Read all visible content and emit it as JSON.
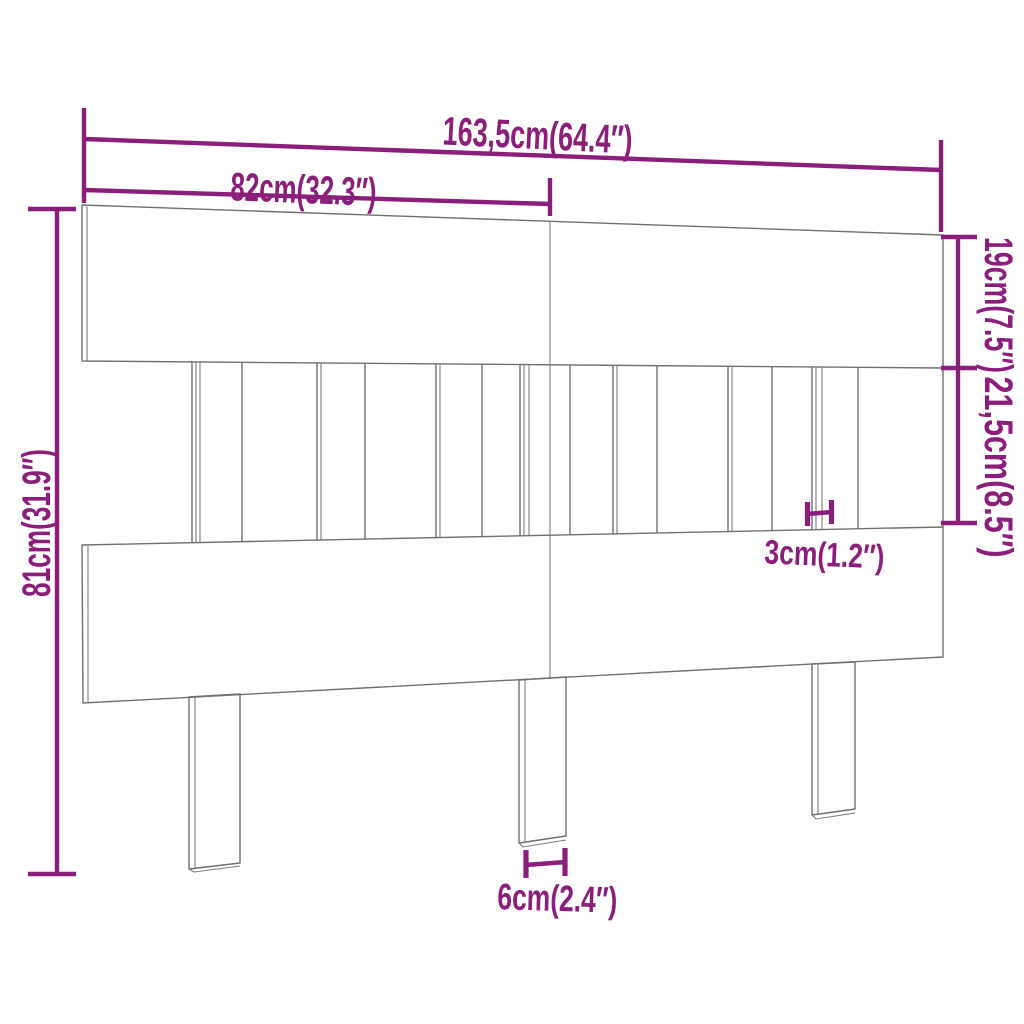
{
  "diagram": {
    "name": "headboard-dimension-diagram",
    "background": "#ffffff",
    "accent_color": "#8B1E7B",
    "outline_color": "#707070",
    "parts": [
      "top-board",
      "slat-section",
      "bottom-board",
      "left-leg",
      "center-leg",
      "right-leg"
    ],
    "dimensions": [
      {
        "id": "overall-width",
        "label": "163,5cm(64.4″)",
        "cm": "163,5",
        "inches": "64.4"
      },
      {
        "id": "half-width",
        "label": "82cm(32.3″)",
        "cm": "82",
        "inches": "32.3"
      },
      {
        "id": "overall-height",
        "label": "81cm(31.9″)",
        "cm": "81",
        "inches": "31.9"
      },
      {
        "id": "top-board-height",
        "label": "19cm(7.5″)",
        "cm": "19",
        "inches": "7.5"
      },
      {
        "id": "slat-section-height",
        "label": "21,5cm(8.5″)",
        "cm": "21,5",
        "inches": "8.5"
      },
      {
        "id": "slat-width",
        "label": "3cm(1.2″)",
        "cm": "3",
        "inches": "1.2"
      },
      {
        "id": "leg-width",
        "label": "6cm(2.4″)",
        "cm": "6",
        "inches": "2.4"
      }
    ]
  }
}
